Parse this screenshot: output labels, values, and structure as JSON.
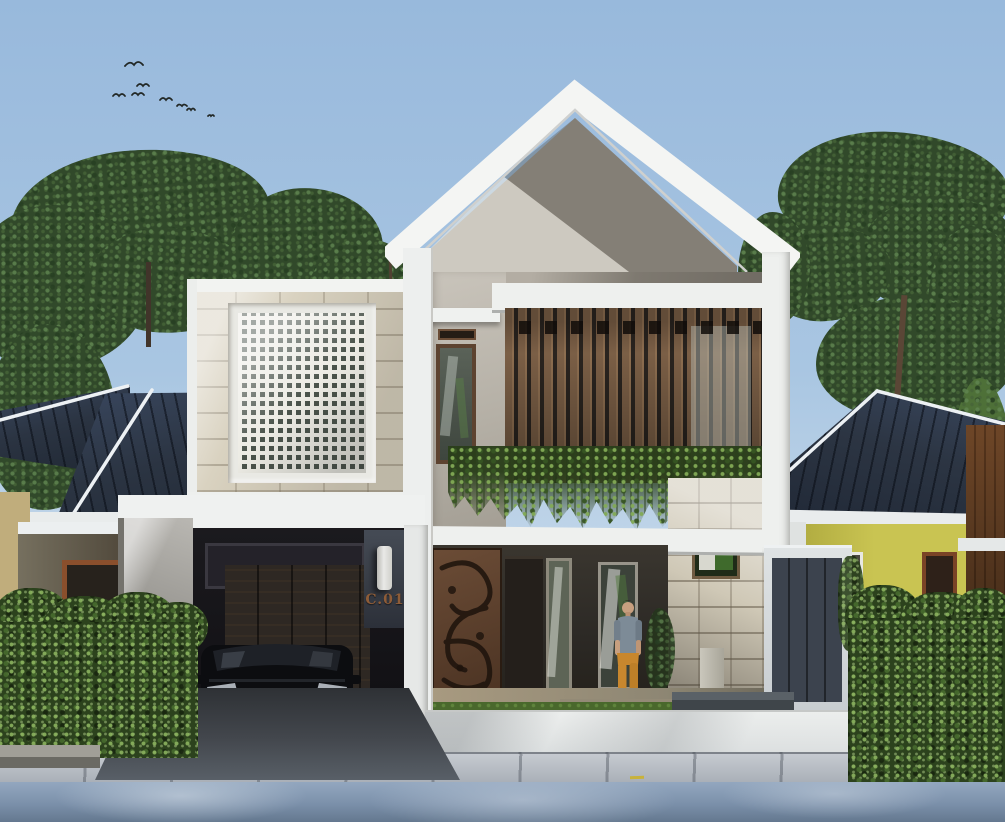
{
  "scene": {
    "type": "architectural exterior render, modern two-storey tropical house",
    "address_label": "C.01",
    "bird_count": 8,
    "figures": "man standing on front porch",
    "vehicles": "black suv parked in carport"
  },
  "palette": {
    "sky_top": "#98b9dc",
    "sky_horizon": "#d4e2ee",
    "roof_fascia_white": "#f4f5f3",
    "gable_concrete": "#a39d94",
    "wood_slats": "#7b5f46",
    "vine_green": "#3a5426",
    "hedge_green": "#2c421d",
    "neighbor_roof_navy": "#2b3442",
    "neighbor_wall_yellow": "#c4bf55",
    "limestone_block": "#cfc8b6",
    "breeze_block_white": "#ecebe4",
    "carport_shadow": "#17161a",
    "car_black": "#0c0d10",
    "street_blue_grey": "#8aa0b8",
    "address_text_copper": "#8d5c38",
    "shirt_grey_blue": "#7d8b97",
    "pants_mustard": "#c8872e",
    "carved_door_wood": "#5f4531"
  }
}
